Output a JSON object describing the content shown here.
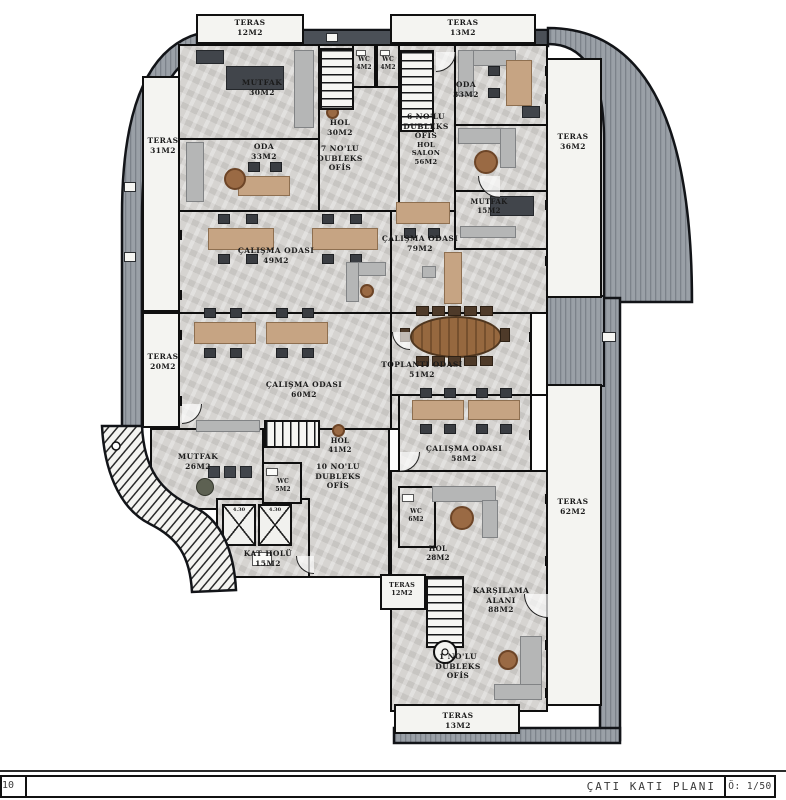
{
  "title_block": {
    "sheet_no": "10",
    "plan_title": "ÇATI KATI PLANI",
    "scale_label": "Ö: 1/50"
  },
  "colors": {
    "band_gray": "#9aa0a7",
    "band_dark": "#4b5057",
    "wall_black": "#101010",
    "floor_marble": "#d6d4d1",
    "terrace_white": "#f4f4f1",
    "desk_tan": "#c6a483",
    "furniture_dark": "#41454b",
    "table_brown": "#96683f"
  },
  "elevator": {
    "label": "4.30"
  },
  "rooms": {
    "teras_12_top": {
      "name": "TERAS",
      "area": "12M2"
    },
    "teras_13_top": {
      "name": "TERAS",
      "area": "13M2"
    },
    "mutfak_30": {
      "name": "MUTFAK",
      "area": "30M2"
    },
    "wc_4_left": {
      "name": "WC",
      "area": "4M2"
    },
    "wc_4_right": {
      "name": "WC",
      "area": "4M2"
    },
    "oda_33_left": {
      "name": "ODA",
      "area": "33M2"
    },
    "oda_33_right": {
      "name": "ODA",
      "area": "33M2"
    },
    "hol_30": {
      "name": "HOL",
      "area": "30M2"
    },
    "ofis_7": {
      "lines": [
        "7 NO'LU",
        "DUBLEKS",
        "OFİS"
      ]
    },
    "ofis_6": {
      "lines": [
        "6 NO'LU",
        "DUBLEKS",
        "OFİS"
      ],
      "sub_lines": [
        "HOL",
        "SALON",
        "56M2"
      ]
    },
    "teras_31": {
      "name": "TERAS",
      "area": "31M2"
    },
    "teras_36": {
      "name": "TERAS",
      "area": "36M2"
    },
    "calisma_49": {
      "name": "ÇALIŞMA ODASI",
      "area": "49M2"
    },
    "calisma_79": {
      "name": "ÇALIŞMA ODASI",
      "area": "79M2"
    },
    "mutfak_15": {
      "name": "MUTFAK",
      "area": "15M2"
    },
    "teras_20": {
      "name": "TERAS",
      "area": "20M2"
    },
    "calisma_60": {
      "name": "ÇALIŞMA ODASI",
      "area": "60M2"
    },
    "toplanti_51": {
      "name": "TOPLANTI ODASI",
      "area": "51M2"
    },
    "calisma_58": {
      "name": "ÇALIŞMA ODASI",
      "area": "58M2"
    },
    "hol_41": {
      "name": "HOL",
      "area": "41M2"
    },
    "mutfak_26": {
      "name": "MUTFAK",
      "area": "26M2"
    },
    "wc_5": {
      "name": "WC",
      "area": "5M2"
    },
    "ofis_10": {
      "lines": [
        "10 NO'LU",
        "DUBLEKS",
        "OFİS"
      ]
    },
    "kat_holu": {
      "name": "KAT HOLÜ",
      "area": "15M2"
    },
    "wc_6": {
      "name": "WC",
      "area": "6M2"
    },
    "teras_62": {
      "name": "TERAS",
      "area": "62M2"
    },
    "hol_28": {
      "name": "HOL",
      "area": "28M2"
    },
    "teras_12_bottom": {
      "name": "TERAS",
      "area": "12M2"
    },
    "karsilama": {
      "lines": [
        "KARŞILAMA",
        "ALANI",
        "88M2"
      ]
    },
    "ofis_1": {
      "lines": [
        "1 NO'LU",
        "DUBLEKS",
        "OFİS"
      ]
    },
    "teras_13_bottom": {
      "name": "TERAS",
      "area": "13M2"
    }
  }
}
